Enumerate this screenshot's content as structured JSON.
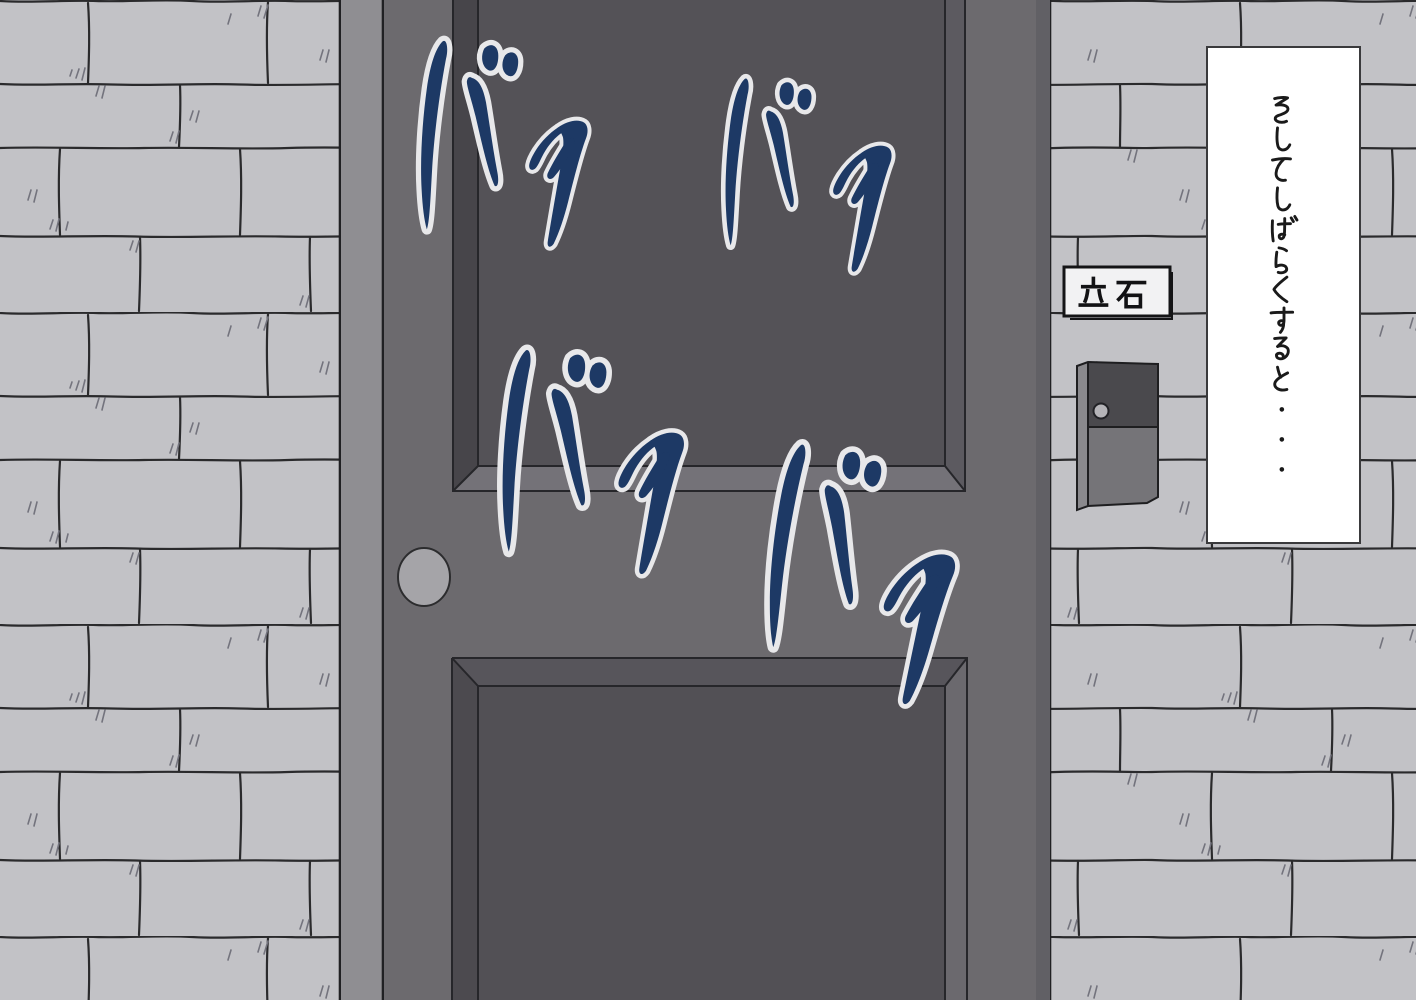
{
  "narration": {
    "text": "そしてしばらくすると・・・"
  },
  "nameplate": {
    "text": "立石"
  },
  "sfx": {
    "items": [
      {
        "text": "バタ"
      },
      {
        "text": "バタ"
      },
      {
        "text": "バタ"
      },
      {
        "text": "バタ"
      }
    ]
  },
  "colors": {
    "brick": "#c2c2c6",
    "mortar": "#2a2a2c",
    "door": "#6c6a6e",
    "door_frame": "#8f8e92",
    "panel_dark": "#545257",
    "sfx_fill": "#1d3965",
    "sfx_outline": "#e8e8ea",
    "ink": "#1a1a1a",
    "bubble_bg": "#ffffff"
  }
}
